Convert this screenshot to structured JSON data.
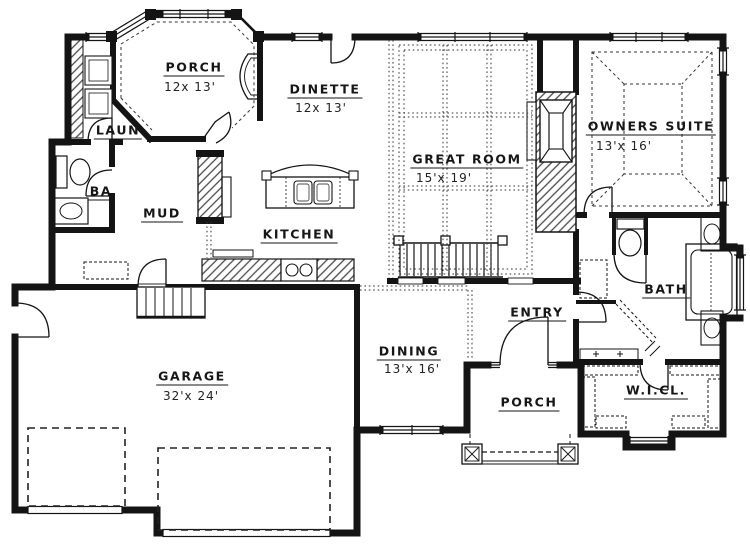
{
  "title": "First floor plan",
  "colors": {
    "wall": "#141414",
    "line": "#333333",
    "background": "#ffffff"
  },
  "rooms": {
    "porch_top": {
      "label": "PORCH",
      "dims": "12x 13'"
    },
    "dinette": {
      "label": "DINETTE",
      "dims": "12x 13'"
    },
    "laundry": {
      "label": "LAUN"
    },
    "bath_half": {
      "label": "BA"
    },
    "mud": {
      "label": "MUD"
    },
    "kitchen": {
      "label": "KITCHEN"
    },
    "great_room": {
      "label": "GREAT ROOM",
      "dims": "15'x 19'"
    },
    "owners_suite": {
      "label": "OWNERS SUITE",
      "dims": "13'x 16'"
    },
    "bath": {
      "label": "BATH"
    },
    "entry": {
      "label": "ENTRY"
    },
    "dining": {
      "label": "DINING",
      "dims": "13'x 16'"
    },
    "porch_bottom": {
      "label": "PORCH"
    },
    "wic": {
      "label": "W.I.CL."
    },
    "garage": {
      "label": "GARAGE",
      "dims": "32'x 24'"
    }
  }
}
